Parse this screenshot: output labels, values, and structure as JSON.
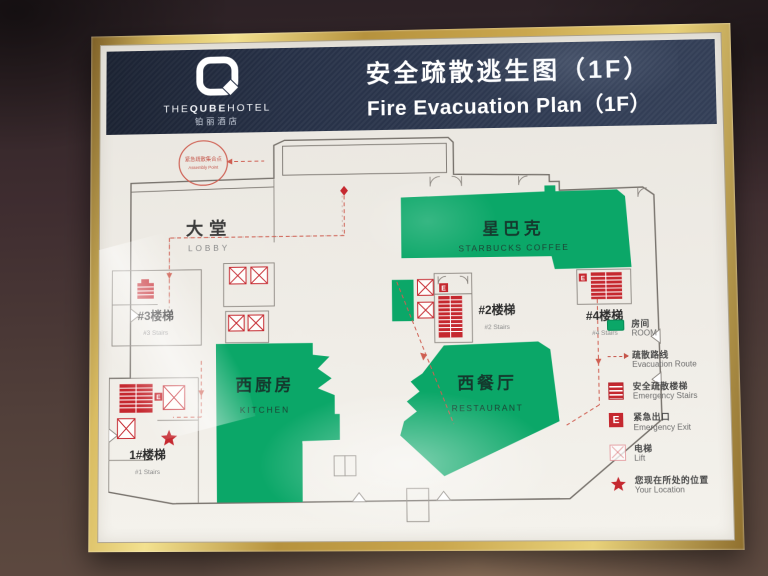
{
  "brand": {
    "the": "THE",
    "qube": "QUBE",
    "hotel": "HOTEL",
    "cn": "铂丽酒店"
  },
  "header": {
    "title_cn": "安全疏散逃生图（1F）",
    "title_en": "Fire Evacuation Plan（1F）"
  },
  "plan": {
    "assembly_point_cn": "紧急疏散集合点",
    "assembly_point_en": "Assembly Point",
    "exit_marker": "E",
    "areas": {
      "lobby": {
        "cn": "大堂",
        "en": "LOBBY"
      },
      "starbucks": {
        "cn": "星巴克",
        "en": "STARBUCKS COFFEE"
      },
      "kitchen": {
        "cn": "西厨房",
        "en": "KITCHEN"
      },
      "restaurant": {
        "cn": "西餐厅",
        "en": "RESTAURANT"
      }
    },
    "stairs": {
      "s3": {
        "cn": "#3楼梯",
        "en": "#3 Stairs"
      },
      "s2": {
        "cn": "#2楼梯",
        "en": "#2 Stairs"
      },
      "s4": {
        "cn": "#4楼梯",
        "en": "#4 Stairs"
      },
      "s1": {
        "cn": "1#楼梯",
        "en": "#1 Stairs"
      }
    }
  },
  "legend": {
    "items": [
      {
        "icon": "room-swatch-icon",
        "cn": "房间",
        "en": "ROOM"
      },
      {
        "icon": "evacuation-route-icon",
        "cn": "疏散路线",
        "en": "Evacuation Route"
      },
      {
        "icon": "emergency-stairs-icon",
        "cn": "安全疏散楼梯",
        "en": "Emergency Stairs"
      },
      {
        "icon": "emergency-exit-icon",
        "cn": "紧急出口",
        "en": "Emergency Exit"
      },
      {
        "icon": "lift-icon",
        "cn": "电梯",
        "en": "Lift"
      },
      {
        "icon": "your-location-icon",
        "cn": "您现在所处的位置",
        "en": "Your Location"
      }
    ]
  },
  "colors": {
    "green": "#0ba768",
    "red": "#c5282f",
    "navy": "#263046",
    "gold": "#caa74e"
  }
}
